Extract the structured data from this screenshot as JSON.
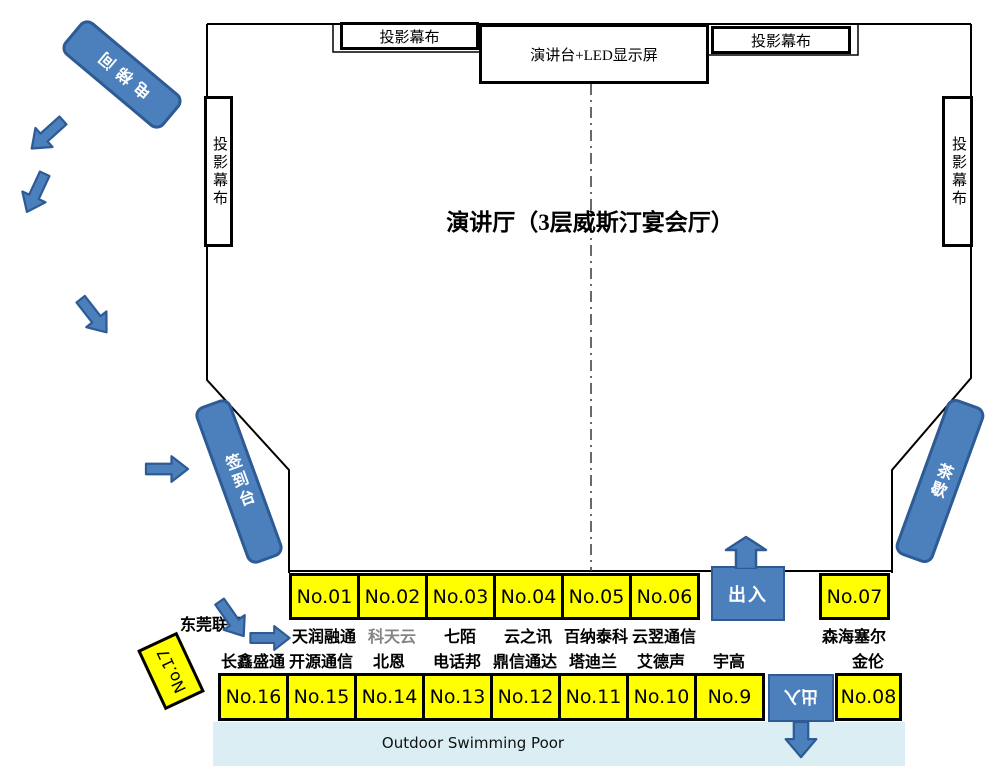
{
  "title": "演讲厅（3层威斯汀宴会厅）",
  "stage": {
    "screen_top_left": "投影幕布",
    "screen_top_right": "投影幕布",
    "screen_left": "投影幕布",
    "screen_right": "投影幕布",
    "podium": "演讲台+LED显示屏"
  },
  "facilities": {
    "elevator": "电梯间",
    "signin_desk": "签到台",
    "tea_break": "茶歇",
    "entrance_top": "出入",
    "entrance_bottom": "出入",
    "pool_label": "Outdoor Swimming Poor",
    "corner_label": "东莞联通"
  },
  "booths": {
    "row1": [
      {
        "no": "No.01",
        "company": "天润融通"
      },
      {
        "no": "No.02",
        "company": "科天云"
      },
      {
        "no": "No.03",
        "company": "七陌"
      },
      {
        "no": "No.04",
        "company": "云之讯"
      },
      {
        "no": "No.05",
        "company": "百纳泰科"
      },
      {
        "no": "No.06",
        "company": "云翌通信"
      },
      {
        "no": "No.07",
        "company": "森海塞尔"
      }
    ],
    "row2": [
      {
        "no": "No.16",
        "company": "长鑫盛通"
      },
      {
        "no": "No.15",
        "company": "开源通信"
      },
      {
        "no": "No.14",
        "company": "北恩"
      },
      {
        "no": "No.13",
        "company": "电话邦"
      },
      {
        "no": "No.12",
        "company": "鼎信通达"
      },
      {
        "no": "No.11",
        "company": "塔迪兰"
      },
      {
        "no": "No.10",
        "company": "艾德声"
      },
      {
        "no": "No.9",
        "company": "宇高"
      },
      {
        "no": "No.08",
        "company": "金伦"
      }
    ],
    "corner": {
      "no": "No.17"
    }
  },
  "colors": {
    "booth_yellow": "#FFFF00",
    "shape_blue": "#4C80BC",
    "shape_blue_border": "#2E5B94",
    "pool_band": "#DAEEF3",
    "muted_label": "#858585"
  }
}
